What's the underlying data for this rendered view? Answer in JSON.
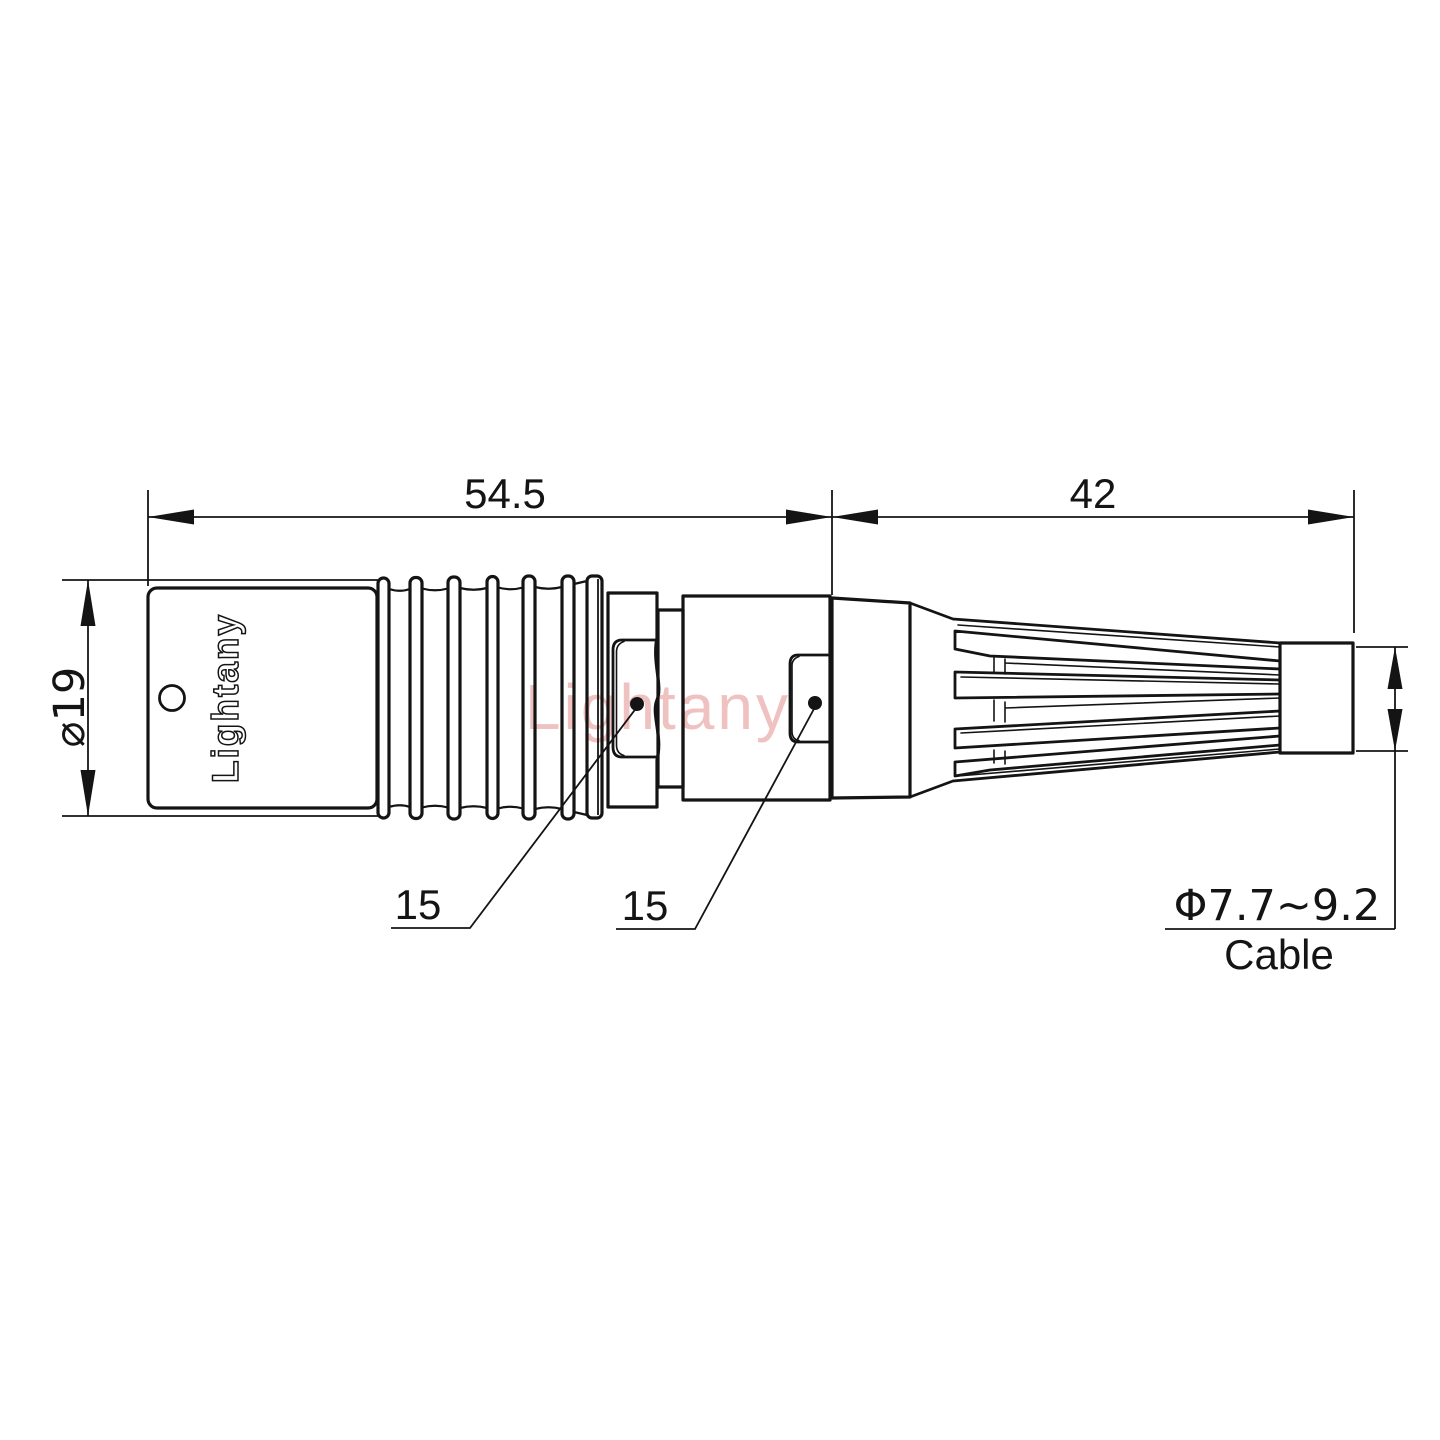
{
  "page": {
    "background_color": "#ffffff",
    "line_color": "#141414",
    "watermark_color": "#e28f8f"
  },
  "watermark": {
    "text": "Lightany"
  },
  "connector": {
    "brand_text": "Lightany"
  },
  "dimensions": {
    "front_length": "54.5",
    "rear_length": "42",
    "body_diameter": "⌀19",
    "front_thread": "15",
    "rear_thread": "15",
    "cable_range": "Φ7.7~9.2",
    "cable_label": "Cable"
  }
}
